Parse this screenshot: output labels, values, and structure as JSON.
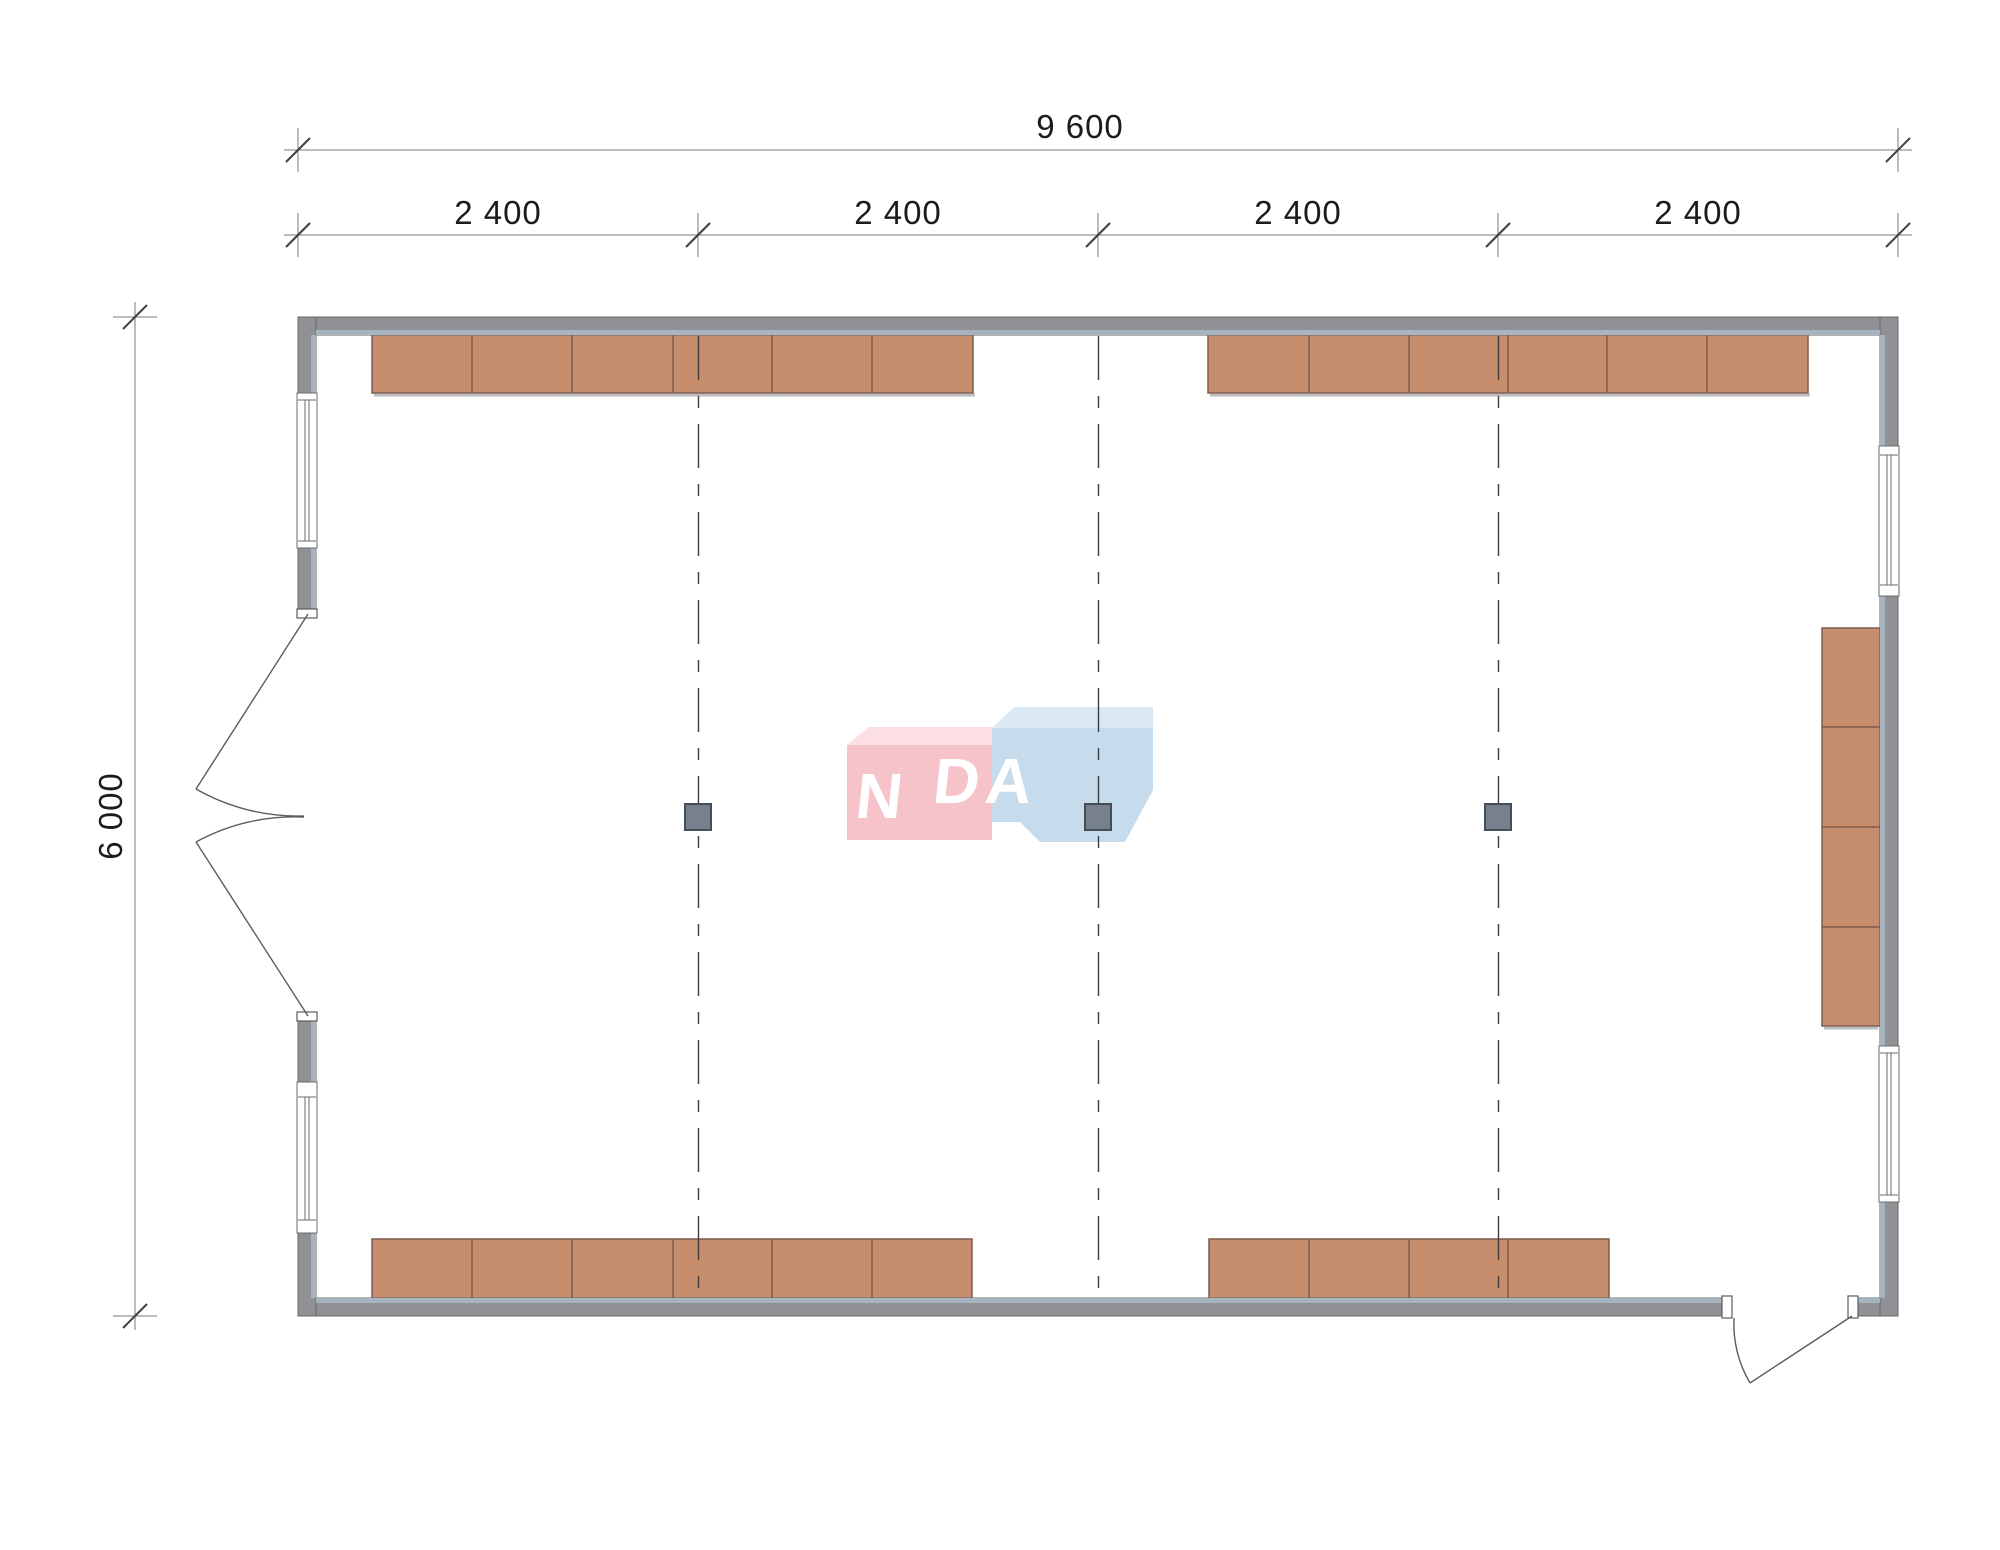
{
  "drawing": {
    "type": "architectural-floor-plan",
    "dimensions": {
      "total_width": "9 600",
      "bays": [
        "2 400",
        "2 400",
        "2 400",
        "2 400"
      ],
      "total_height": "6 000"
    },
    "watermark": {
      "brand": "VANDA",
      "text_left": "VAN",
      "text_right": "DA"
    },
    "elements": {
      "columns": 3,
      "windows": 4,
      "double_leaf_doors": 1,
      "single_leaf_doors": 1,
      "cabinet_runs": [
        {
          "name": "top-left",
          "segments": 6
        },
        {
          "name": "top-right",
          "segments": 6
        },
        {
          "name": "bottom-left",
          "segments": 6
        },
        {
          "name": "bottom-right",
          "segments": 4
        },
        {
          "name": "right-wall",
          "segments": 4
        }
      ]
    },
    "colors": {
      "wall": "#8F9194",
      "wall-outline": "#66686A",
      "wall-liner": "#A6B4C0",
      "window-frame": "#6A6C6E",
      "door": "#5A5C5E",
      "cabinet": "#C78E6E",
      "cabinet-outline": "#7E5B4B",
      "cabinet-shadow": "#ACAEB0",
      "grid": "#3D3D3D",
      "column": "#76818D",
      "column-outline": "#454D56",
      "dim-line": "#7A7A7A",
      "dim-tick": "#3F3F3F",
      "dim-text": "#1B1B1B",
      "logo-pink": "#F6C3CA",
      "logo-pink-top": "#FBDFE3",
      "logo-blue": "#C6DBEB",
      "logo-blue-top": "#DAE9F4",
      "logo-text": "#FFFFFF"
    }
  }
}
